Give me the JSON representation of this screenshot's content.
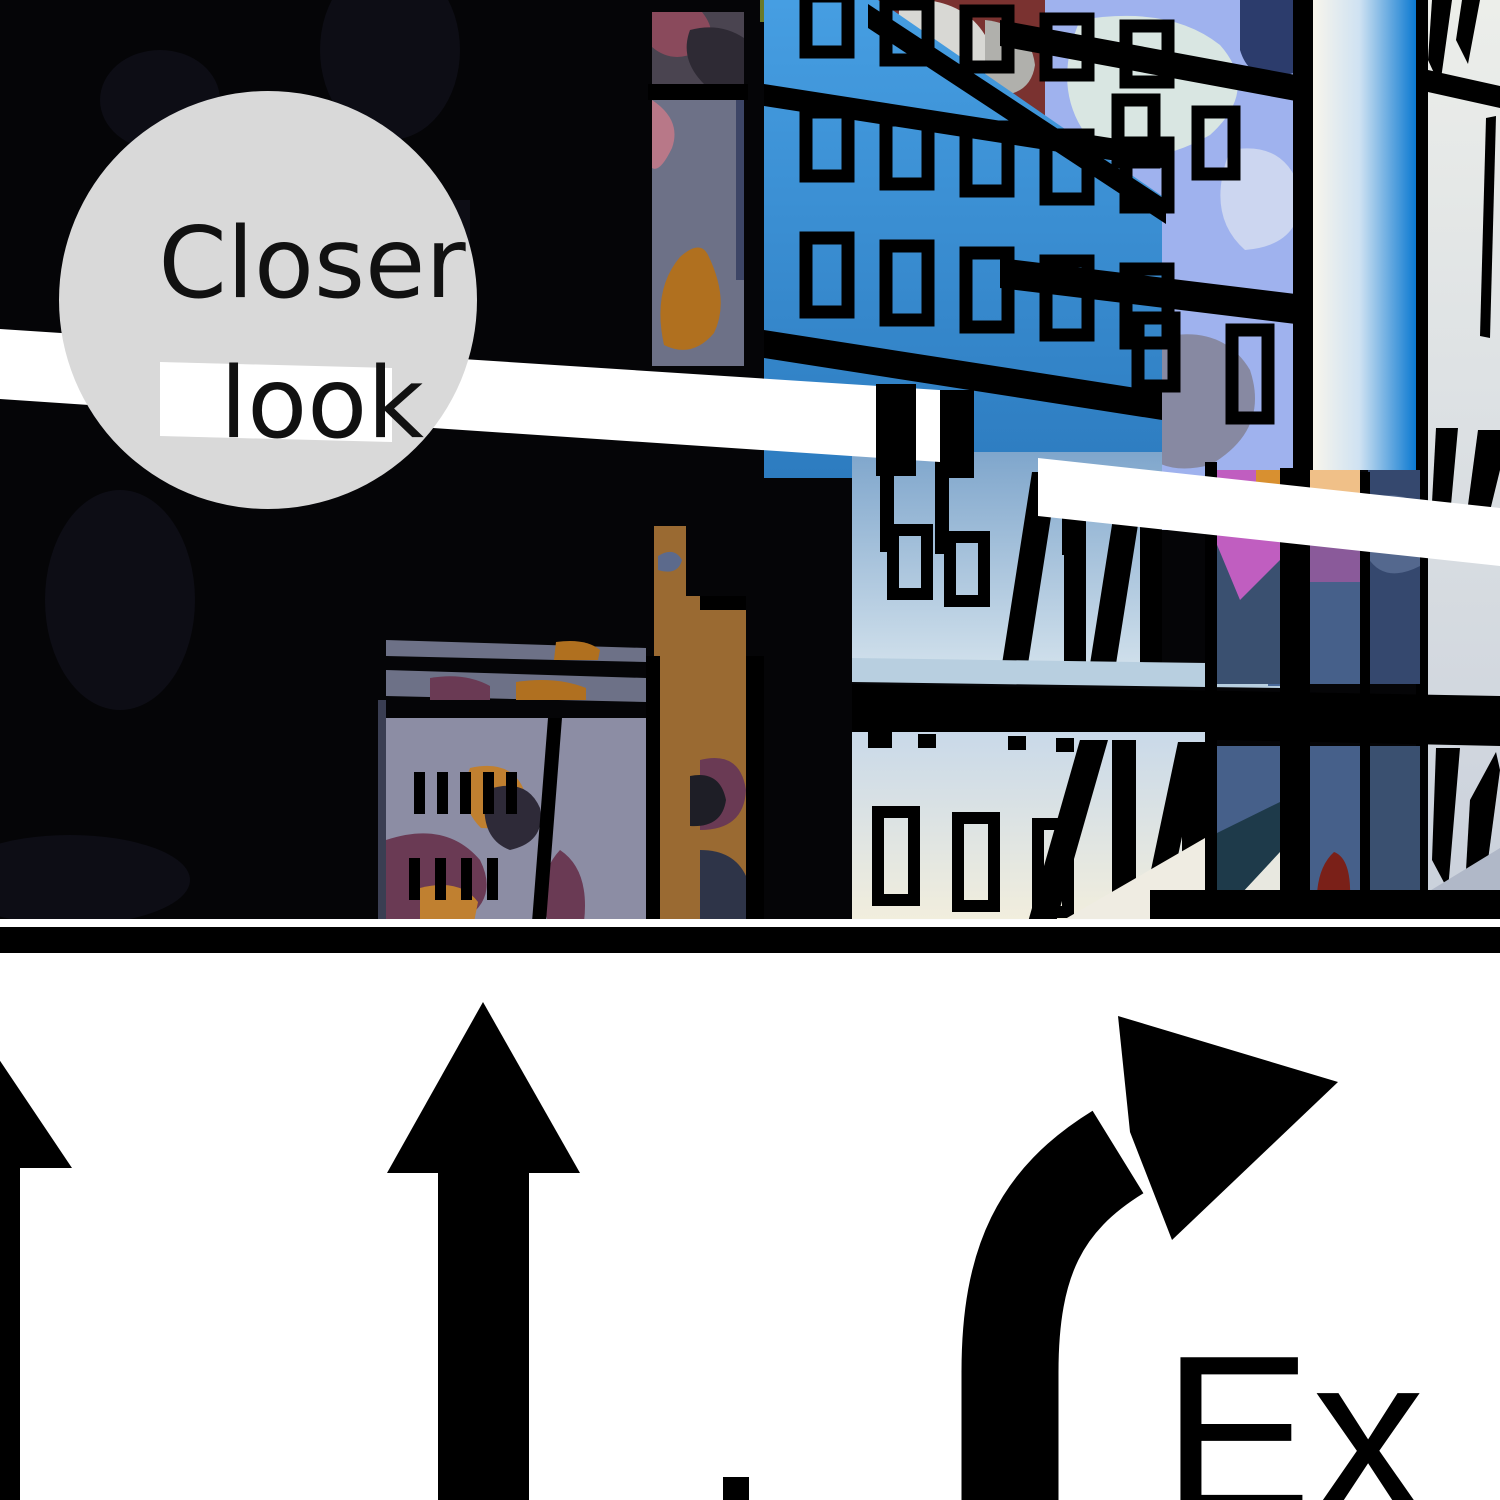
{
  "badge": {
    "line1": "Closer",
    "line2": "look",
    "circle_color": "#d9d9d9",
    "text_color": "#111111"
  },
  "sign": {
    "exit_text": "Ex",
    "background": "#ffffff",
    "arrow_color": "#000000",
    "arrows": [
      "straight-up-partial-left",
      "straight-up-center",
      "curved-right-exit"
    ],
    "letter_fragment": "partial letter bar at bottom center"
  },
  "scene": {
    "description": "vector cityscape viewed through black window mullions",
    "elements": [
      "blue-gradient-building",
      "mottled-periwinkle-collage",
      "white-highway-beam",
      "glass-gradient-tower",
      "gray-slash-building",
      "cream-building-fire-escapes",
      "brown-tower",
      "lavender-wall-with-camo",
      "window-grid-colored-panes"
    ],
    "palette": {
      "scene_black": "#050507",
      "sky_blue_top": "#469ee2",
      "sky_blue_bottom": "#2d7cc0",
      "periwinkle": "#9fb2ee",
      "mint": "#d9e6e2",
      "beam_white": "#ffffff",
      "tower_blue": "#0b79d1",
      "right_gray": "#e9ebe7",
      "cream": "#f2eedd",
      "pale_blue_wall": "#cfdfeb",
      "light_band": "#b8cfe0",
      "brown": "#9a6a32",
      "lavender_wall": "#8c8da4",
      "maroon": "#6a3a54",
      "orange_leaf": "#b0701f",
      "magenta_pane": "#c05ec0",
      "peach_pane": "#f0c088",
      "navy_pane": "#35486e",
      "slate_pane": "#46608a",
      "teal_shadow": "#1e3a4a",
      "dark_red": "#7a2018",
      "maroon_roof": "#7a3230",
      "green_tree": "#74a85a"
    }
  },
  "divider": {
    "thin_white_line": "#fdfdfd",
    "black_band": "#000000"
  }
}
